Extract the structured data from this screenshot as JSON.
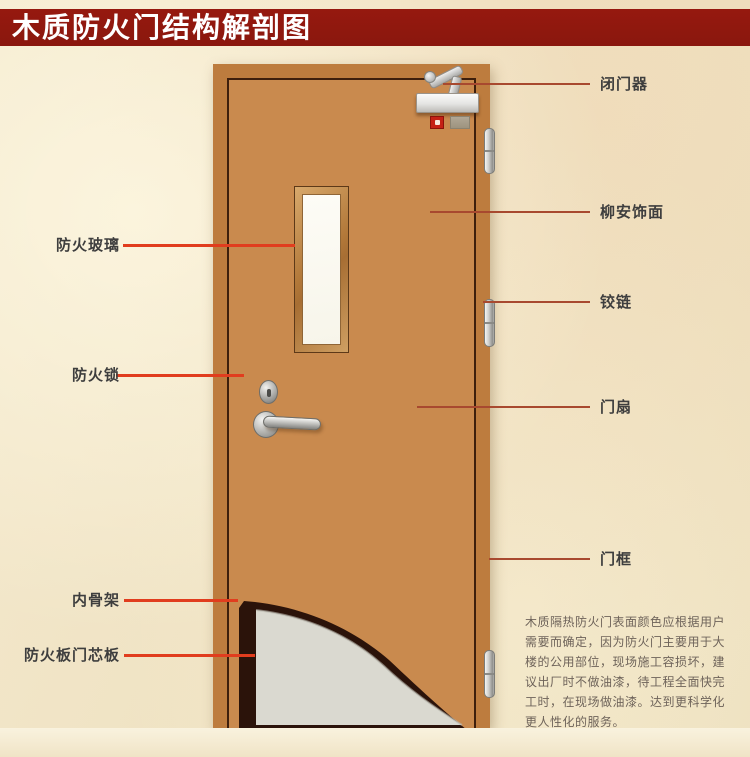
{
  "title": "木质防火门结构解剖图",
  "labels": {
    "left": [
      {
        "text": "防火玻璃"
      },
      {
        "text": "防火锁"
      },
      {
        "text": "内骨架"
      },
      {
        "text": "防火板门芯板"
      }
    ],
    "right": [
      {
        "text": "闭门器"
      },
      {
        "text": "柳安饰面"
      },
      {
        "text": "铰链"
      },
      {
        "text": "门扇"
      },
      {
        "text": "门框"
      }
    ]
  },
  "note": {
    "lines": [
      "木质隔热防火门表面颜色应根据用户",
      "需要而确定，因为防火门主要用于大",
      "楼的公用部位，现场施工容损坏，建",
      "议出厂时不做油漆，待工程全面快完",
      "工时，在现场做油漆。达到更科学化",
      "更人性化的服务。"
    ]
  },
  "colors": {
    "banner": "#8e1a10",
    "wood": "#c98a4e",
    "frame_wood": "#bd7c3e",
    "leader_left": "#e13d1e",
    "leader_right": "#a8492f",
    "core_panel": "#dad9d0",
    "cutaway_dark": "#2b130a",
    "glass": "#fbfaf2"
  }
}
